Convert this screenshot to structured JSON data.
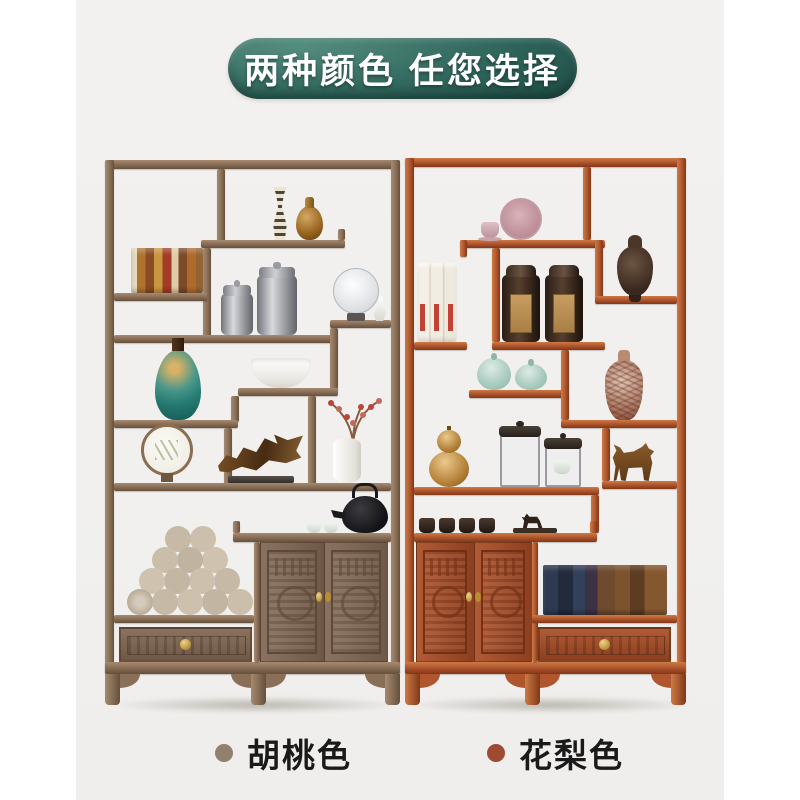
{
  "banner": {
    "text": "两种颜色 任您选择"
  },
  "legend": {
    "items": [
      {
        "label": "胡桃色",
        "bullet_color": "#92806f"
      },
      {
        "label": "花梨色",
        "bullet_color": "#9e4a33"
      }
    ]
  },
  "colors": {
    "page_bg": "#ffffff",
    "photo_bg": "#f1f0ee",
    "banner_light": "#538d7e",
    "banner_dark": "#163f3a",
    "walnut": "#8a6f58",
    "rosewood": "#b0562e",
    "text": "#1a1a1a"
  },
  "cabinets": [
    {
      "id": "walnut",
      "color_label": "胡桃色",
      "decor_items": [
        "striped vase",
        "amber glass vase",
        "row of books",
        "pewter tea caddies",
        "glass fan disc",
        "crane figurine",
        "turquoise vase",
        "white bowl",
        "red berry branch in white vase",
        "round silk fan",
        "driftwood sculpture",
        "black teapot with cups",
        "stacked scrolls",
        "carved double doors",
        "carved drawer"
      ]
    },
    {
      "id": "rosewood",
      "color_label": "花梨色",
      "decor_items": [
        "pink plate and cup",
        "white scroll books",
        "tea tins",
        "bronze censer",
        "celadon jars",
        "patterned vase",
        "golden gourd vase",
        "glass display cases",
        "horse figurine",
        "black teacups",
        "deer figurine",
        "row of books",
        "carved double doors",
        "carved drawer"
      ]
    }
  ]
}
